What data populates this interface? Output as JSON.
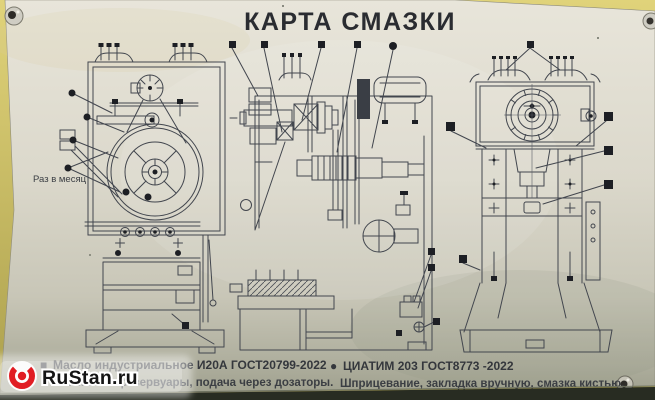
{
  "title": "КАРТА СМАЗКИ",
  "annotations": {
    "once_per_month": "Раз в месяц"
  },
  "legend": {
    "oil": {
      "symbol": "■",
      "name": "Масло индустриальное И20А ГОСТ20799-2022",
      "method": "Заливка в резервуары, подача через дозаторы."
    },
    "grease": {
      "symbol": "●",
      "name": "ЦИАТИМ 203 ГОСТ8773 -2022",
      "method": "Шприцевание, закладка вручную, смазка кистью."
    }
  },
  "watermark": {
    "text": "RuStan.ru",
    "logo_color": "#e11d23"
  },
  "colors": {
    "plate": "#d9d6c9",
    "wall": "#d5c86e",
    "drawing_line": "#42464e",
    "marker": "#1d1f24",
    "watermark_red": "#e11d23"
  }
}
